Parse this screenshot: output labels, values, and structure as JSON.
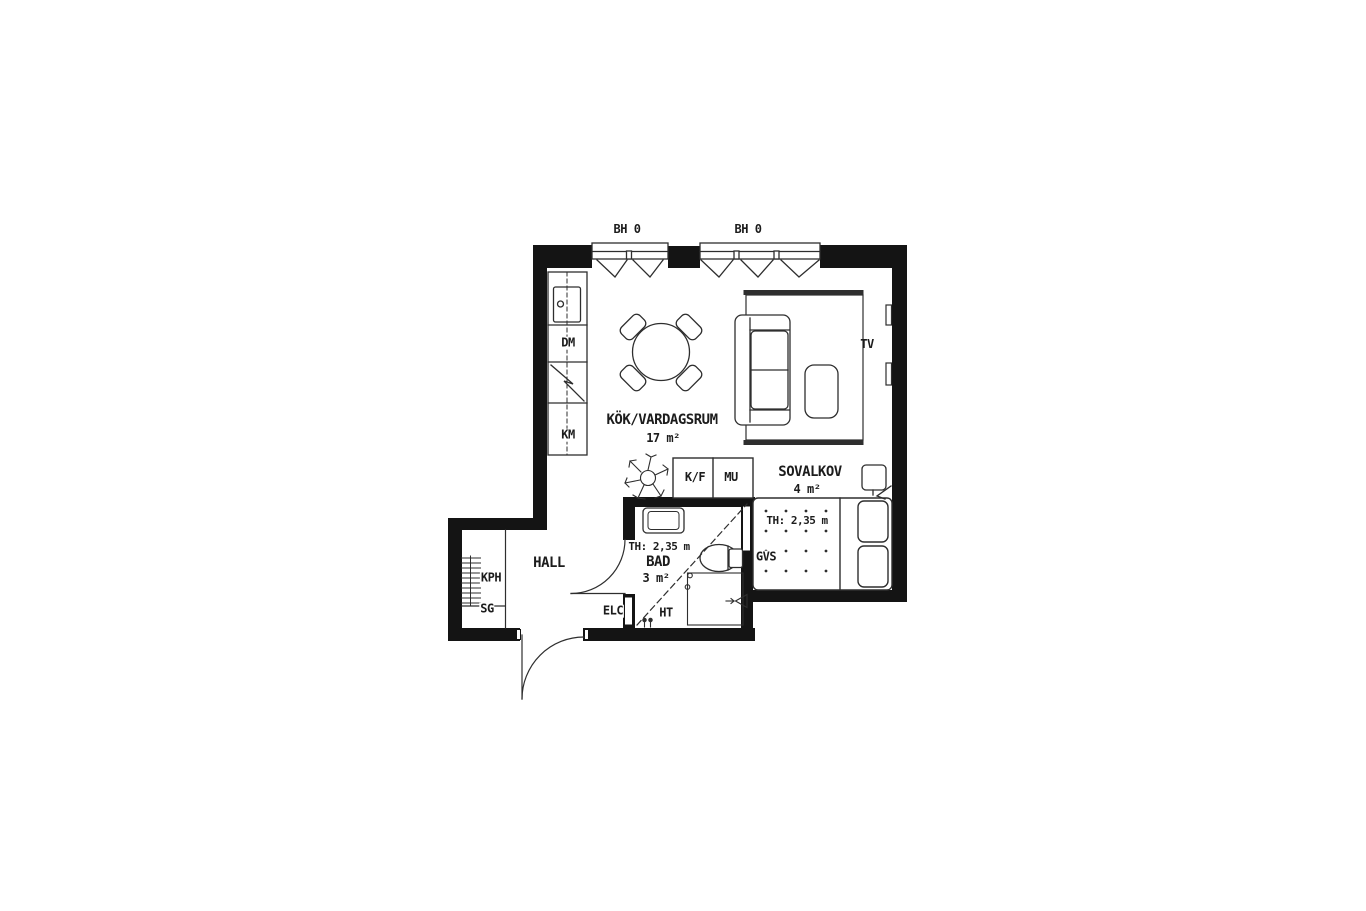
{
  "title": "Apartment floor plan",
  "colors": {
    "wall": "#141414",
    "line": "#2e2e2e",
    "background": "#ffffff",
    "text": "#1c1c1c"
  },
  "rooms": {
    "kitchen_living": {
      "name": "KÖK/VARDAGSRUM",
      "area": "17 m²"
    },
    "sleeping_alcove": {
      "name": "SOVALKOV",
      "area": "4 m²",
      "ceiling_height": "TH: 2,35 m",
      "shaft": "GVS"
    },
    "bathroom": {
      "name": "BAD",
      "area": "3 m²",
      "ceiling_height": "TH: 2,35 m",
      "towel_dryer": "HT"
    },
    "hall": {
      "name": "HALL",
      "coat_rail": "KPH",
      "shelf": "SG",
      "electrical_cabinet": "ELC"
    }
  },
  "fixtures": {
    "dishwasher": "DM",
    "washing_machine": "KM",
    "fridge_freezer": "K/F",
    "microwave": "MU",
    "tv": "TV"
  },
  "windows": {
    "window1_sill": "BH 0",
    "window2_sill": "BH 0"
  }
}
